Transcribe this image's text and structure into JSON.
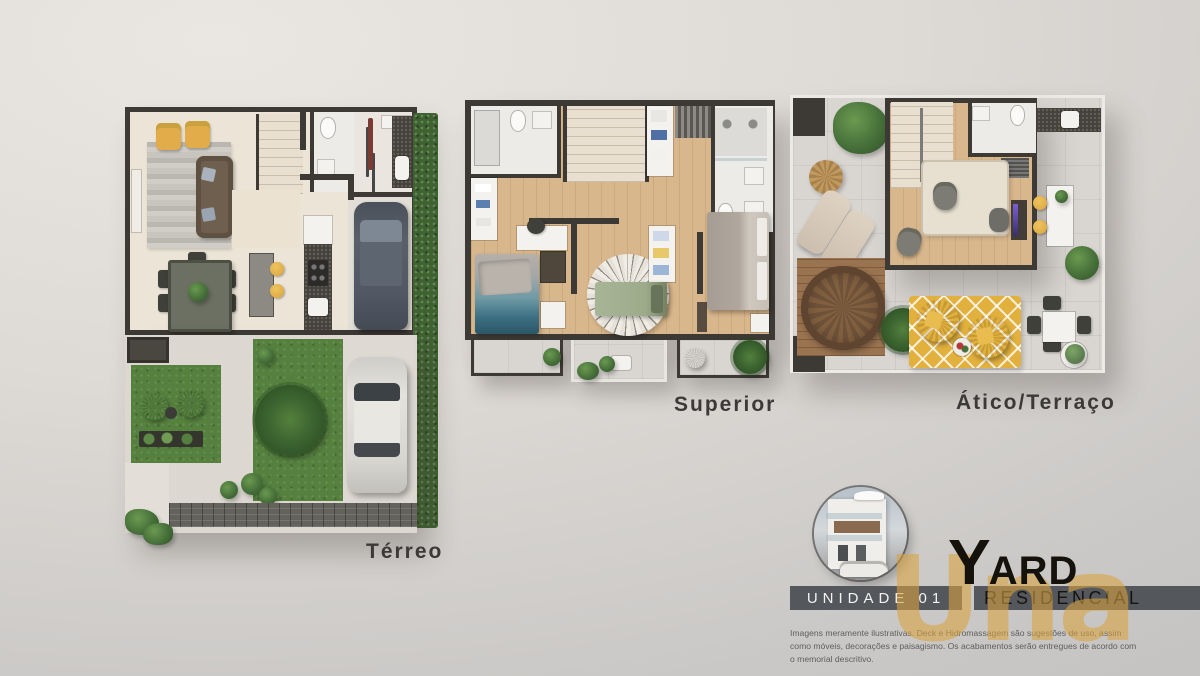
{
  "plans": [
    {
      "id": "terreo",
      "label": "Térreo"
    },
    {
      "id": "superior",
      "label": "Superior"
    },
    {
      "id": "atico",
      "label": "Ático/Terraço"
    }
  ],
  "branding": {
    "unit_label": "UNIDADE 01",
    "brand_initial": "Y",
    "brand_rest": "ARD",
    "brand_subtitle": "RESIDENCIAL",
    "watermark": "Una",
    "disclaimer": "Imagens meramente ilustrativas. Deck e Hidromassagem são sugestões de uso, assim como móveis, decorações e paisagismo. Os acabamentos serão entregues de acordo com o memorial descritivo."
  },
  "palette": {
    "wall": "#3d3935",
    "floor_cream": "#ece4d7",
    "floor_wood": "#d9b78c",
    "terrace_tile": "#d9d6d2",
    "grass": "#55803e",
    "hedge": "#3f6330",
    "deck_wood": "#9a7350",
    "accent_gold": "#d9a33f",
    "banner_gray": "#54575c",
    "rug_yellow": "#e1b03d",
    "car_dark": "#525864",
    "car_white": "#d9d7d2",
    "armchair_yellow": "#e2ac4a",
    "bed_teal": "#3a6e80",
    "bed_green": "#9dab8b",
    "bed_gray": "#c6bfb6"
  }
}
